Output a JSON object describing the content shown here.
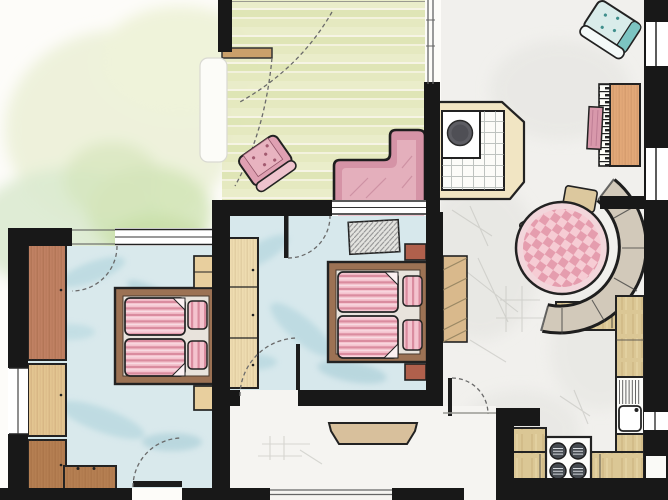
{
  "app": {
    "kind": "hand-drawn watercolor apartment floor plan",
    "visible_text": []
  },
  "palette": {
    "wall": "#181818",
    "paper": "#fdfcf9",
    "floor_blue": "#d7e8ec",
    "floor_blue_streak": "#aed3dc",
    "deck_green_a": "#e9ecc8",
    "deck_green_b": "#dde4b2",
    "garden_green": "#dcead0",
    "living_gray": "#f1f0ed",
    "pink_sofa": "#d593a6",
    "pink_textile": "#f4c3ce",
    "pink_stripe": "#d9899c",
    "check_pink": "#e59dae",
    "teal_chair": "#d9ecea",
    "teal_accent": "#72bcba",
    "wood_red": "#c08163",
    "wood_brown": "#b57f52",
    "wood_tan": "#e3c591",
    "wood_pale": "#eedcb0",
    "wood_orange": "#e2a878",
    "counter_tan": "#dbc795",
    "bench_gray": "#d2c9ba",
    "frame_brown": "#9c7254",
    "mattress": "#e8e3dc",
    "cooktop_dark": "#464b51",
    "nightstand_red": "#b0604c"
  },
  "elements": {
    "garden": "garden lawn (watercolor wash)",
    "terrace": "terrace with wooden deck boards",
    "sofa_l": "L-shaped pink sofa on terrace",
    "armchair_pink": "pink armchair on terrace",
    "curtain": "curtain at terrace door",
    "shelf_terrace": "small wooden shelf",
    "living_room": "living and dining room",
    "tiled_stove": "tiled stove / fireplace with hearth",
    "armchair_teal": "teal armchair",
    "piano": "piano with key strip",
    "piano_bench": "pink piano bench",
    "wardrobe_living": "hatched cabinet against bedroom wall",
    "dining_set": "round table with gingham cloth, corner bench and three chairs",
    "kitchen": "kitchen with counters, sink and cooktop",
    "sink": "kitchen sink with drainboard",
    "cooktop": "four-burner cooktop",
    "bedroom_middle": "middle bedroom with double bed",
    "bedroom_left": "left bedroom with double bed",
    "bed_double": "double bed with striped duvets and pillows",
    "wardrobe": "wardrobe cabinet",
    "nightstand": "nightstand",
    "rug": "hatched rug",
    "dresser": "low dresser",
    "hall": "entrance hall",
    "coat_shelf": "hall wardrobe shelf",
    "door_swing": "door swing arc",
    "window": "window in wall"
  }
}
